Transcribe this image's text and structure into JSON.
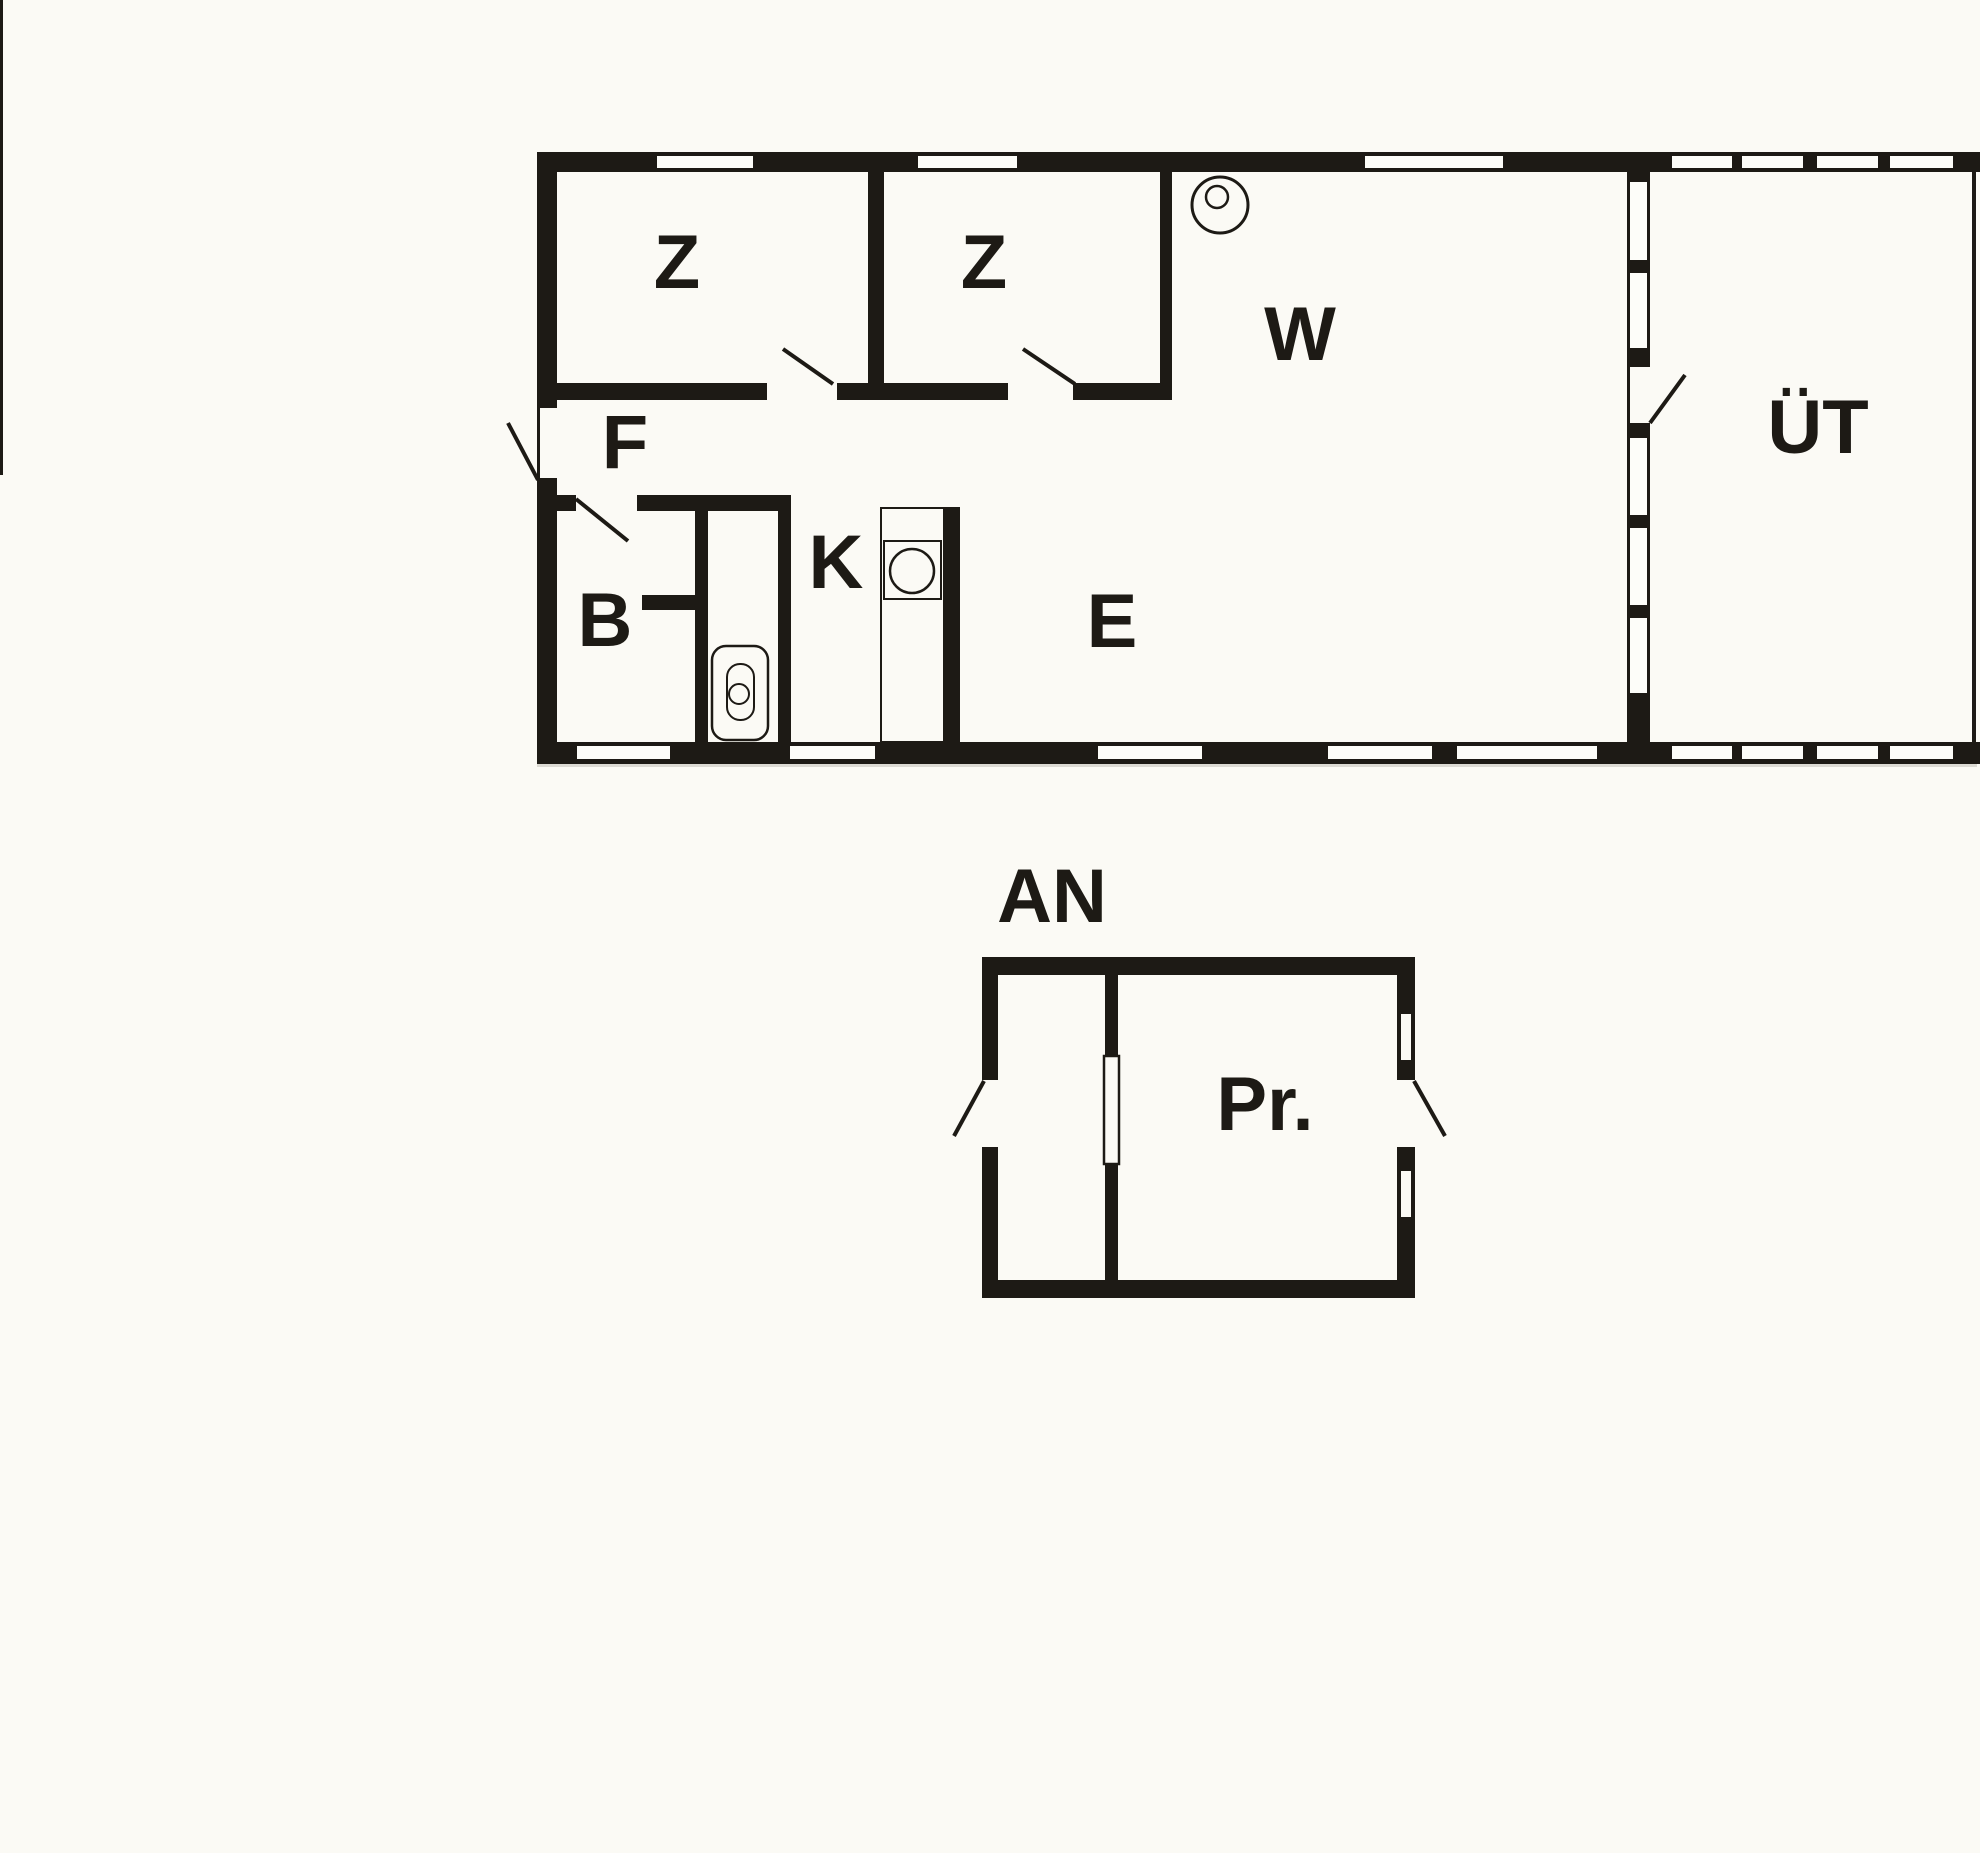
{
  "document": {
    "type": "floor-plan",
    "sheets": [
      "main-house",
      "annex"
    ]
  },
  "colors": {
    "wall": "#1d1a15",
    "paper": "#fbfaf5",
    "glass": "#fdfdf9"
  },
  "labels": {
    "bedroom1": "Z",
    "bedroom2": "Z",
    "living_room": "W",
    "covered_terrace": "ÜT",
    "hallway": "F",
    "bathroom": "B",
    "kitchen": "K",
    "dining_area": "E",
    "annex_title": "AN",
    "annex_room": "Pr."
  }
}
